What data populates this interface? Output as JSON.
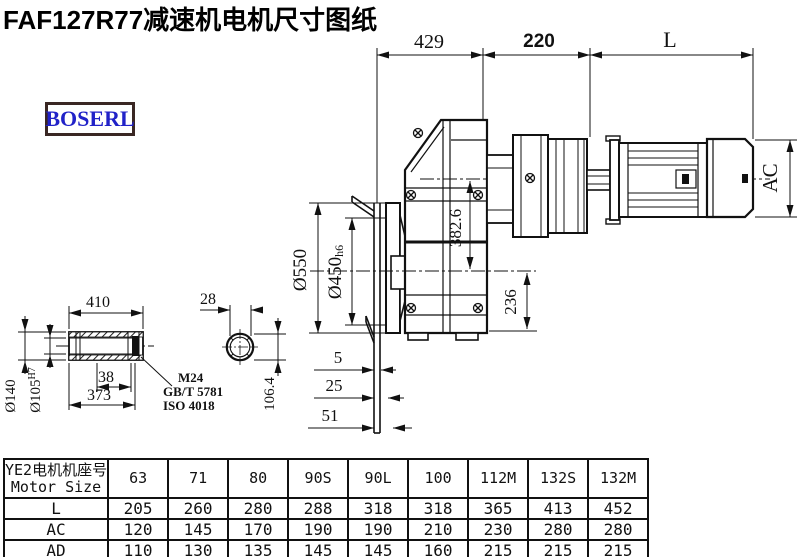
{
  "title": "FAF127R77减速机电机尺寸图纸",
  "brand": "BOSERL",
  "dims": {
    "width_gearbox": "429",
    "width_adapter": "220",
    "motor_length": "L",
    "center_distance": "382.6",
    "flange_od": "Ø550",
    "spigot_dia": "Ø450",
    "spigot_tol": "h6",
    "axis_to_base": "236",
    "plate_gap": "5",
    "plate_thickness": "25",
    "plate_total": "51",
    "motor_dia": "AC",
    "shaft_length": "410",
    "ring_width": "38",
    "shaft_inner_length": "373",
    "shaft_od": "Ø140",
    "bore_dia": "Ø105",
    "bore_tol": "H7",
    "key_width": "28",
    "key_height": "106.4",
    "thread_spec": "M24",
    "standard_gb": "GB/T 5781",
    "standard_iso": "ISO 4018"
  },
  "table": {
    "header_cn": "YE2电机机座号",
    "header_en": "Motor Size",
    "columns": [
      "63",
      "71",
      "80",
      "90S",
      "90L",
      "100",
      "112M",
      "132S",
      "132M"
    ],
    "rows": [
      {
        "label": "L",
        "values": [
          "205",
          "260",
          "280",
          "288",
          "318",
          "318",
          "365",
          "413",
          "452"
        ]
      },
      {
        "label": "AC",
        "values": [
          "120",
          "145",
          "170",
          "190",
          "190",
          "210",
          "230",
          "280",
          "280"
        ]
      },
      {
        "label": "AD",
        "values": [
          "110",
          "130",
          "135",
          "145",
          "145",
          "160",
          "215",
          "215",
          "215"
        ]
      }
    ]
  }
}
